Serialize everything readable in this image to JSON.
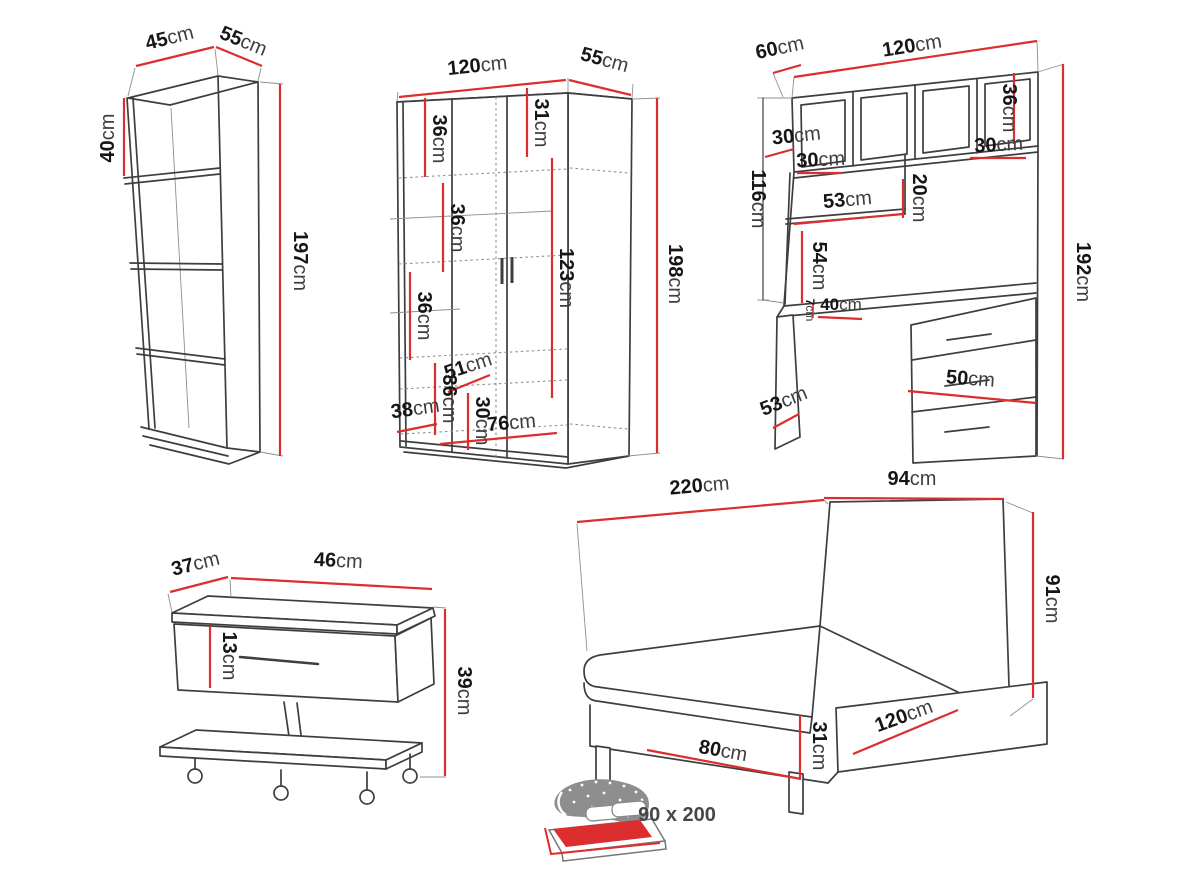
{
  "diagram": {
    "title": "furniture-dimensions",
    "colors": {
      "dimension_line": "#dc2e2e",
      "drawing_line": "#3e3e3e",
      "number_text": "#161616",
      "unit_text": "#3f3f3f",
      "icon_gray": "#8e8e8e"
    },
    "furniture": {
      "bookshelf": {
        "labels": {
          "width": {
            "v": "45",
            "u": "cm"
          },
          "depth": {
            "v": "55",
            "u": "cm"
          },
          "compartment": {
            "v": "40",
            "u": "cm"
          },
          "height": {
            "v": "197",
            "u": "cm"
          }
        }
      },
      "wardrobe": {
        "labels": {
          "width": {
            "v": "120",
            "u": "cm"
          },
          "depth": {
            "v": "55",
            "u": "cm"
          },
          "top_left": {
            "v": "36",
            "u": "cm"
          },
          "top_right": {
            "v": "31",
            "u": "cm"
          },
          "mid_left": {
            "v": "36",
            "u": "cm"
          },
          "door": {
            "v": "123",
            "u": "cm"
          },
          "low_left": {
            "v": "36",
            "u": "cm"
          },
          "shelf": {
            "v": "51",
            "u": "cm"
          },
          "lower_left": {
            "v": "36",
            "u": "cm"
          },
          "bottom": {
            "v": "30",
            "u": "cm"
          },
          "plinth": {
            "v": "38",
            "u": "cm"
          },
          "interior": {
            "v": "76",
            "u": "cm"
          },
          "height": {
            "v": "198",
            "u": "cm"
          }
        }
      },
      "desk": {
        "labels": {
          "depth": {
            "v": "60",
            "u": "cm"
          },
          "width": {
            "v": "120",
            "u": "cm"
          },
          "cab_depth": {
            "v": "30",
            "u": "cm"
          },
          "cab_left": {
            "v": "30",
            "u": "cm"
          },
          "cab_height": {
            "v": "36",
            "u": "cm"
          },
          "cab_right": {
            "v": "30",
            "u": "cm"
          },
          "left_height": {
            "v": "116",
            "u": "cm"
          },
          "shelf_height": {
            "v": "20",
            "u": "cm"
          },
          "shelf_width": {
            "v": "53",
            "u": "cm"
          },
          "panel_height": {
            "v": "54",
            "u": "cm"
          },
          "total_height": {
            "v": "192",
            "u": "cm"
          },
          "top_thickness": {
            "v": "7",
            "u": "cm"
          },
          "desktop_depth": {
            "v": "40",
            "u": "cm"
          },
          "drawer_width": {
            "v": "50",
            "u": "cm"
          },
          "leg_depth": {
            "v": "53",
            "u": "cm"
          }
        }
      },
      "nightstand": {
        "labels": {
          "depth": {
            "v": "37",
            "u": "cm"
          },
          "width": {
            "v": "46",
            "u": "cm"
          },
          "drawer": {
            "v": "13",
            "u": "cm"
          },
          "height": {
            "v": "39",
            "u": "cm"
          }
        }
      },
      "bed": {
        "labels": {
          "length": {
            "v": "220",
            "u": "cm"
          },
          "headboard_width": {
            "v": "94",
            "u": "cm"
          },
          "headboard_height": {
            "v": "91",
            "u": "cm"
          },
          "base_height": {
            "v": "31",
            "u": "cm"
          },
          "drawer_length": {
            "v": "120",
            "u": "cm"
          },
          "foot_width": {
            "v": "80",
            "u": "cm"
          }
        }
      }
    },
    "bed_size_icon": {
      "label": "90 x 200"
    }
  }
}
